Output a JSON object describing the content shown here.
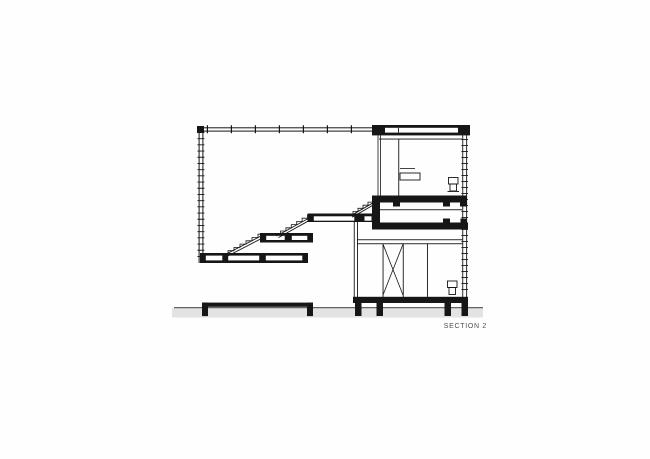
{
  "page": {
    "background": "#fefefe"
  },
  "drawing": {
    "label": "SECTION 2",
    "colors": {
      "ink": "#161616",
      "paper": "#ffffff",
      "ground_fill": "#e3e3e3",
      "ground_line": "#3d3d3d",
      "label_text": "#4f4f4f"
    }
  }
}
